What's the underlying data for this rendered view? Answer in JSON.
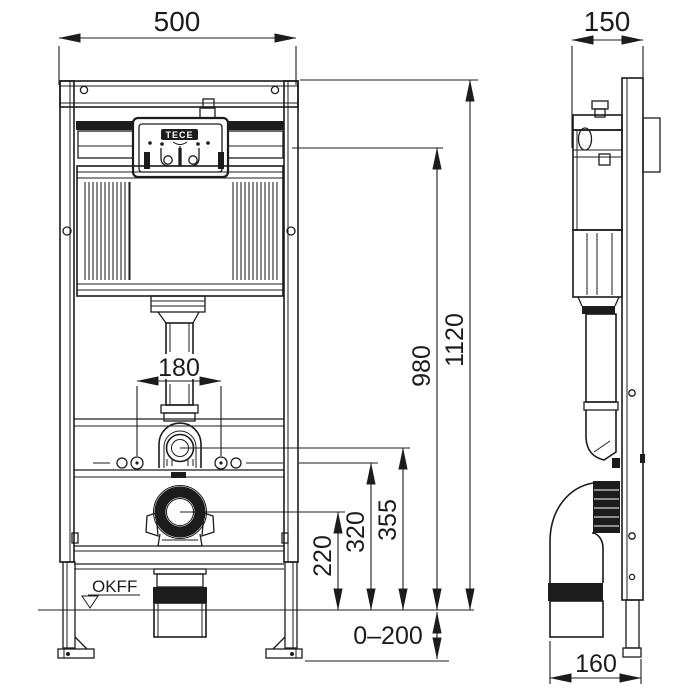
{
  "drawing": {
    "type": "technical-installation-drawing",
    "views": [
      "front",
      "side"
    ],
    "colors": {
      "ink": "#1c1c1c",
      "background": "#ffffff"
    }
  },
  "labels": {
    "brand": "TECE",
    "floor_level": "OKFF"
  },
  "dims": {
    "width_front": "500",
    "depth_side": "150",
    "height_total": "1120",
    "height_actuation": "980",
    "height_flush_pipe": "355",
    "height_bolts": "320",
    "height_drain": "220",
    "spacing_bolts": "180",
    "floor_range": "0–200",
    "outlet_offset": "160"
  }
}
